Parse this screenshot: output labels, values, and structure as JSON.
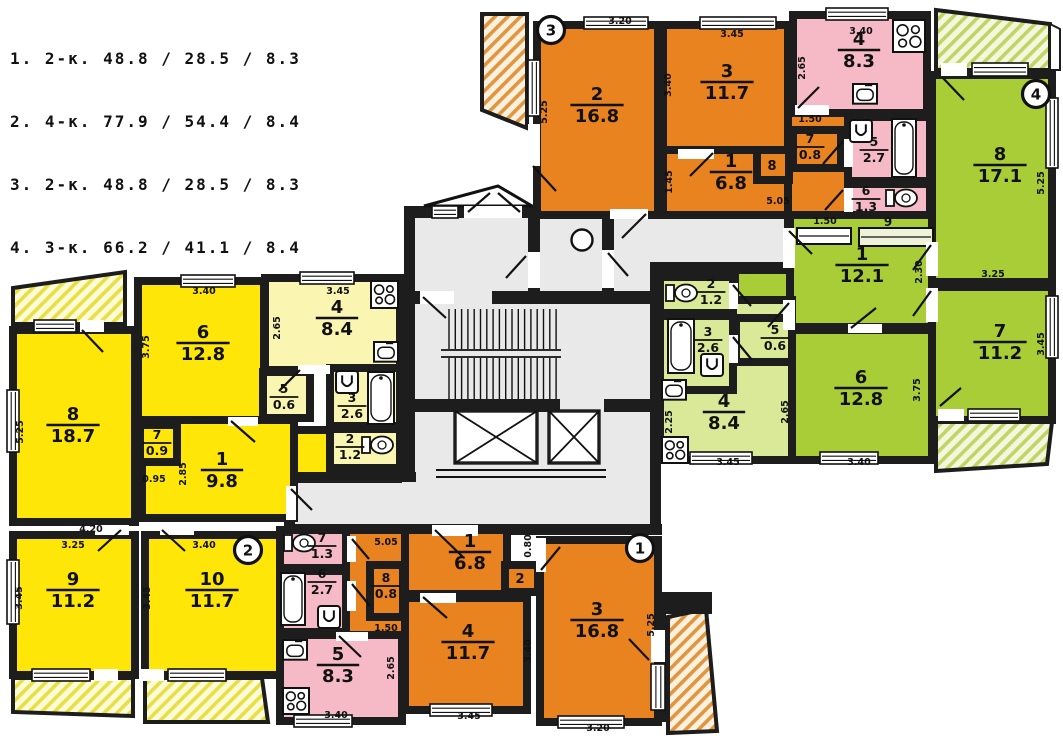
{
  "legend": {
    "lines": [
      "1. 2-к. 48.8 / 28.5 / 8.3",
      "2. 4-к. 77.9 / 54.4 / 8.4",
      "3. 2-к. 48.8 / 28.5 / 8.3",
      "4. 3-к. 66.2 / 41.1 / 8.4"
    ]
  },
  "apartments": {
    "apt1": {
      "badge": "1",
      "rooms": [
        {
          "num": "1",
          "area": "6.8"
        },
        {
          "num": "2",
          "area": ""
        },
        {
          "num": "3",
          "area": "16.8"
        },
        {
          "num": "4",
          "area": "11.7"
        },
        {
          "num": "5",
          "area": "8.3"
        },
        {
          "num": "6",
          "area": "2.7"
        },
        {
          "num": "7",
          "area": "1.3"
        },
        {
          "num": "8",
          "area": "0.8"
        }
      ]
    },
    "apt2": {
      "badge": "2",
      "rooms": [
        {
          "num": "1",
          "area": "9.8"
        },
        {
          "num": "2",
          "area": "1.2"
        },
        {
          "num": "3",
          "area": "2.6"
        },
        {
          "num": "4",
          "area": "8.4"
        },
        {
          "num": "5",
          "area": "0.6"
        },
        {
          "num": "6",
          "area": "12.8"
        },
        {
          "num": "7",
          "area": "0.9"
        },
        {
          "num": "8",
          "area": "18.7"
        },
        {
          "num": "9",
          "area": "11.2"
        },
        {
          "num": "10",
          "area": "11.7"
        }
      ]
    },
    "apt3": {
      "badge": "3",
      "rooms": [
        {
          "num": "1",
          "area": "6.8"
        },
        {
          "num": "2",
          "area": "16.8"
        },
        {
          "num": "3",
          "area": "11.7"
        },
        {
          "num": "4",
          "area": "8.3"
        },
        {
          "num": "5",
          "area": "2.7"
        },
        {
          "num": "6",
          "area": "1.3"
        },
        {
          "num": "7",
          "area": "0.8"
        },
        {
          "num": "8",
          "area": ""
        }
      ]
    },
    "apt4": {
      "badge": "4",
      "rooms": [
        {
          "num": "1",
          "area": "12.1"
        },
        {
          "num": "2",
          "area": "1.2"
        },
        {
          "num": "3",
          "area": "2.6"
        },
        {
          "num": "4",
          "area": "8.4"
        },
        {
          "num": "5",
          "area": "0.6"
        },
        {
          "num": "6",
          "area": "12.8"
        },
        {
          "num": "7",
          "area": "11.2"
        },
        {
          "num": "8",
          "area": "17.1"
        },
        {
          "num": "9",
          "area": ""
        }
      ]
    }
  },
  "dims": [
    "3.20",
    "5.25",
    "3.45",
    "3.40",
    "1.45",
    "5.05",
    "1.50",
    "3.40",
    "2.65",
    "1.50",
    "2.30",
    "3.25",
    "5.25",
    "3.45",
    "3.75",
    "3.40",
    "2.65",
    "2.25",
    "3.45",
    "3.40",
    "3.75",
    "3.45",
    "2.65",
    "5.25",
    "4.20",
    "0.95",
    "2.85",
    "3.25",
    "3.40",
    "3.45",
    "3.45",
    "5.05",
    "1.50",
    "2.65",
    "3.40",
    "0.80",
    "3.40",
    "3.45",
    "3.20",
    "5.25"
  ],
  "colors": {
    "orange": "#E8831F",
    "pink": "#F5BAC6",
    "yellow": "#FFE609",
    "pale_yellow": "#FAF6B2",
    "green": "#A9CD37",
    "pale_green": "#DAE998",
    "corridor_gray": "#E9E9E9",
    "wall": "#1D1D1D",
    "hatch_orange": "#E2953F",
    "hatch_orange_bg": "#FBF1DE",
    "hatch_yellow": "#E8DF45",
    "hatch_yellow_bg": "#FDFBD8",
    "hatch_green": "#C1D566",
    "hatch_green_bg": "#F4F7DD"
  },
  "fixtures": {
    "stove": "stove-icon",
    "kitchen_sink": "kitchen-sink-icon",
    "washbasin": "washbasin-icon",
    "bathtub": "bathtub-icon",
    "toilet": "toilet-icon",
    "garbage_chute": "garbage-chute-icon",
    "stairs": "stairs",
    "elevator": "elevator-icon",
    "entrance_canopy": "entrance-canopy"
  }
}
